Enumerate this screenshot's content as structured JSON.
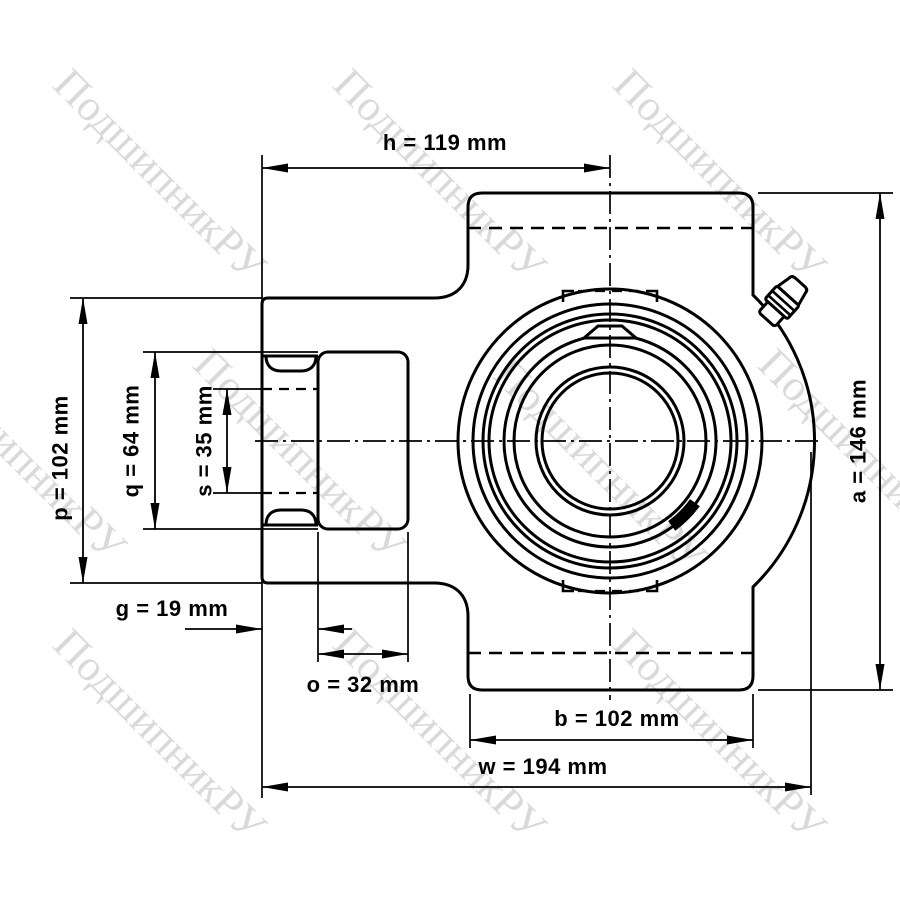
{
  "dimensions": {
    "h": {
      "label": "h = 119 mm"
    },
    "p": {
      "label": "p = 102 mm"
    },
    "q": {
      "label": "q = 64 mm"
    },
    "s": {
      "label": "s = 35 mm"
    },
    "g": {
      "label": "g = 19 mm"
    },
    "o": {
      "label": "o = 32 mm"
    },
    "b": {
      "label": "b = 102 mm"
    },
    "w": {
      "label": "w = 194 mm"
    },
    "a": {
      "label": "a = 146 mm"
    }
  },
  "watermark": {
    "text": "ПодшипникРУ",
    "color": "rgba(0,0,0,0.15)"
  },
  "colors": {
    "line": "#000000",
    "bore_fill": "#d9d9d9",
    "background": "#ffffff"
  }
}
